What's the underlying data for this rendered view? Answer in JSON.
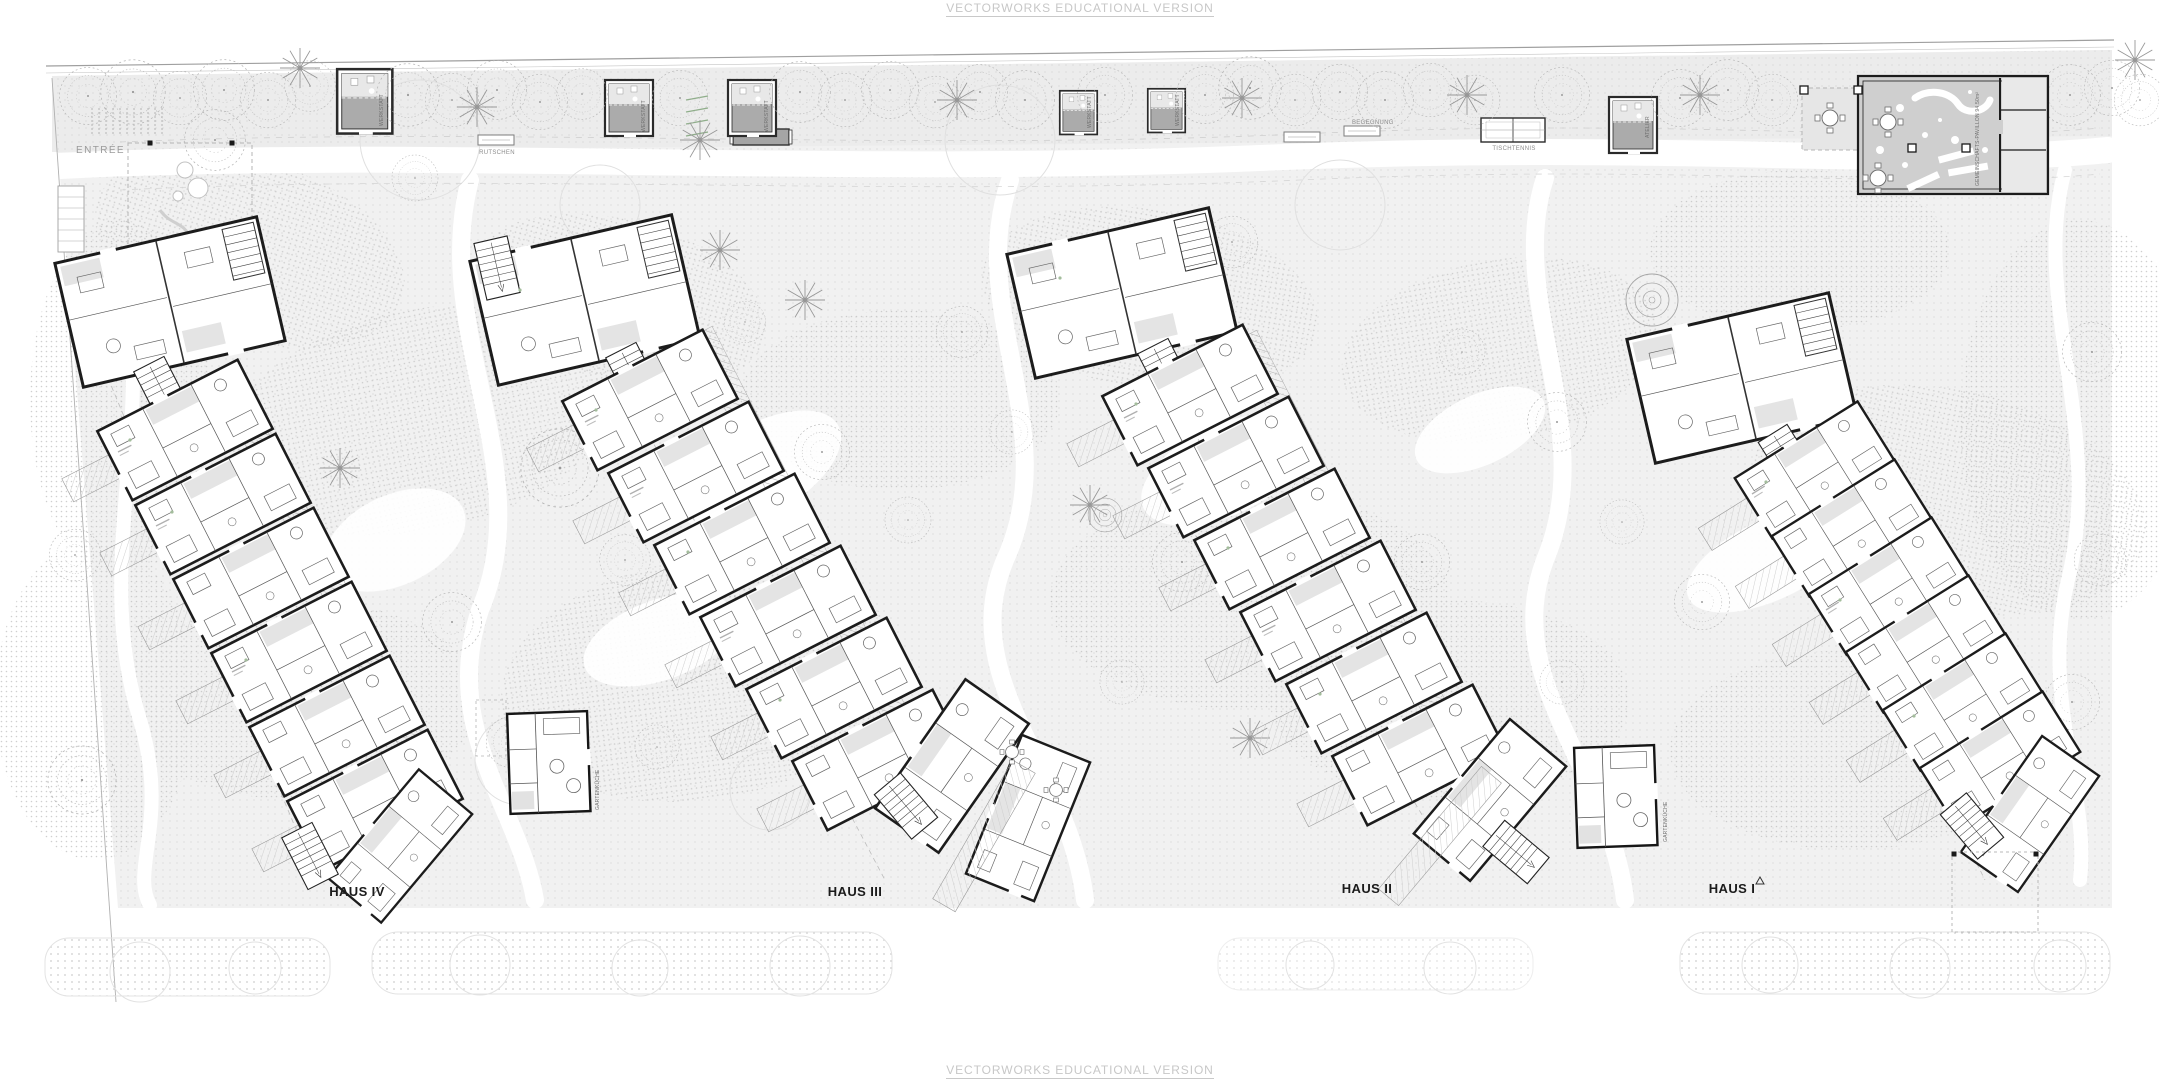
{
  "watermark": {
    "text": "VECTORWORKS EDUCATIONAL VERSION"
  },
  "site": {
    "entrance_label": "ENTRÉE",
    "labels": {
      "slides": "RUTSCHEN",
      "table_tennis": "TISCHTENNIS",
      "meeting": "BEGEGNUNG"
    },
    "houses": [
      {
        "name": "HAUS IV"
      },
      {
        "name": "HAUS III"
      },
      {
        "name": "HAUS II"
      },
      {
        "name": "HAUS I"
      }
    ],
    "pavilions": [
      {
        "label": "WERKSTATT"
      },
      {
        "label": "WERKSTATT"
      },
      {
        "label": "WERKSTATT"
      },
      {
        "label": "WERKSTATT"
      },
      {
        "label": "WERKSTATT"
      },
      {
        "label": "ATELIER"
      }
    ],
    "community_label": "GEMEINSCHAFTS-PAVILLON 94.50m²",
    "service_buildings": [
      {
        "label": "GARTENKÜCHE"
      },
      {
        "label": "GARTENKÜCHE"
      }
    ]
  },
  "colors": {
    "ground": "#f1f1f1",
    "walls": "#1c1c1c",
    "pavilion_fill": "#ababab",
    "community_floor": "#cfcfcf",
    "watermark": "#c7c7c7",
    "tree_stroke": "#b3b3b3"
  }
}
